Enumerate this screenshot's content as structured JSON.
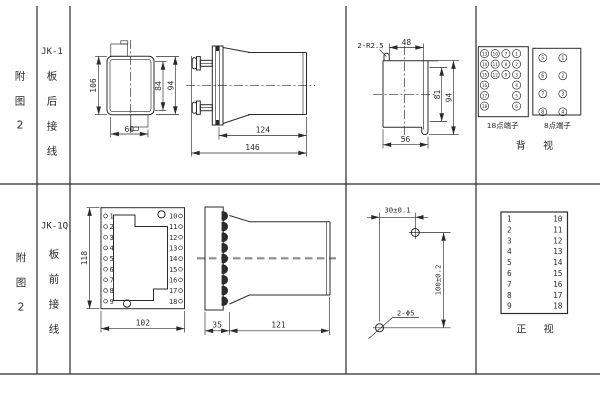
{
  "colors": {
    "line": "#2b2b2b",
    "centerline_gray": "#8c8c8c",
    "bg": "#ffffff"
  },
  "top_row": {
    "fig_chars": [
      "附",
      "图",
      "2"
    ],
    "model": "JK-1",
    "wiring_chars": [
      "板",
      "后",
      "接",
      "线"
    ],
    "front_view": {
      "dim_total_height": "106",
      "dim_inner_height": "84",
      "dim_flange_height": "94",
      "dim_width": "60"
    },
    "side_view": {
      "dim_body_depth": "124",
      "dim_total_depth": "146"
    },
    "cutout_view": {
      "note_radius": "2-R2.5",
      "dim_top_width": "48",
      "dim_inner_height": "81",
      "dim_outer_height": "94",
      "dim_bottom_width": "56"
    },
    "terminals_18": {
      "caption": "18点端子",
      "columns": [
        [
          13,
          14,
          15,
          16,
          17,
          18
        ],
        [
          10,
          11,
          12
        ],
        [
          7,
          8,
          9
        ],
        [
          1,
          2,
          3,
          4,
          5,
          6
        ]
      ]
    },
    "terminals_8": {
      "caption": "8点端子",
      "columns": [
        [
          5,
          6,
          7,
          8
        ],
        [
          1,
          2,
          3,
          4
        ]
      ]
    },
    "view_caption": "背 视"
  },
  "bottom_row": {
    "fig_chars": [
      "附",
      "图",
      "2"
    ],
    "model": "JK-1Q",
    "wiring_chars": [
      "板",
      "前",
      "接",
      "线"
    ],
    "front_view": {
      "left_terminals": [
        1,
        2,
        3,
        4,
        5,
        6,
        7,
        8,
        9
      ],
      "right_terminals": [
        10,
        11,
        12,
        13,
        14,
        15,
        16,
        17,
        18
      ],
      "dim_height": "118",
      "dim_width": "102"
    },
    "side_view": {
      "dim_plate_depth": "35",
      "dim_body_depth": "121"
    },
    "drill_view": {
      "dim_hole_spacing_x": "30±0.1",
      "dim_hole_spacing_y": "100±0.2",
      "note_holes": "2-Φ5"
    },
    "terminal_table": {
      "left": [
        1,
        2,
        3,
        4,
        5,
        6,
        7,
        8,
        9
      ],
      "right": [
        10,
        11,
        12,
        13,
        14,
        15,
        16,
        17,
        18
      ],
      "caption": "正 视"
    }
  }
}
